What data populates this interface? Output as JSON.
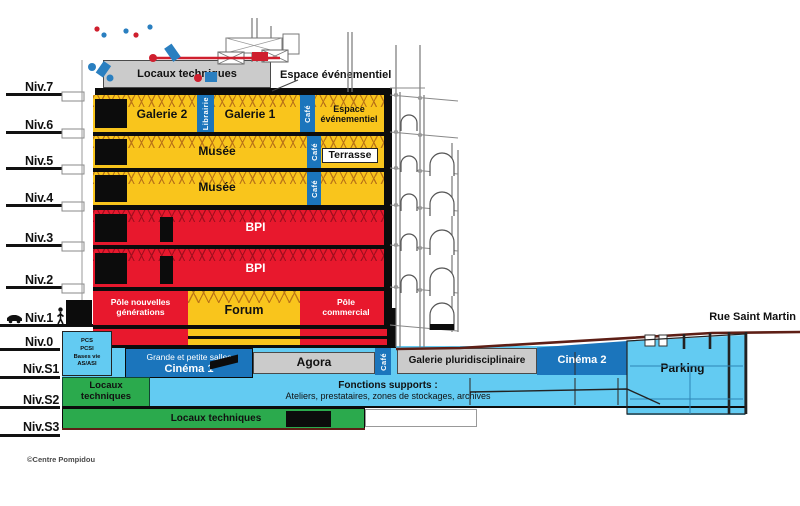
{
  "levels": [
    {
      "label": "Niv.7"
    },
    {
      "label": "Niv.6"
    },
    {
      "label": "Niv.5"
    },
    {
      "label": "Niv.4"
    },
    {
      "label": "Niv.3"
    },
    {
      "label": "Niv.2"
    },
    {
      "label": "Niv.1"
    },
    {
      "label": "Niv.0"
    },
    {
      "label": "Niv.S1"
    },
    {
      "label": "Niv.S2"
    },
    {
      "label": "Niv.S3"
    }
  ],
  "labels": {
    "locaux_techniques": "Locaux techniques",
    "espace_evenementiel": "Espace événementiel",
    "espace_evenementiel_2l": "Espace\névénementiel",
    "galerie2": "Galerie 2",
    "librairie": "Librairie",
    "galerie1": "Galerie 1",
    "cafe": "Café",
    "musee": "Musée",
    "terrasse": "Terrasse",
    "bpi": "BPI",
    "pole_nouvelles": "Pôle nouvelles\ngénérations",
    "forum": "Forum",
    "pole_commercial": "Pôle\ncommercial",
    "pcs_block": "PCS\nPCSI\nBases vie\nAS/ASI",
    "cinema1_sub": "Grande et petite salles",
    "cinema1": "Cinéma 1",
    "agora": "Agora",
    "galerie_pluridisciplinaire": "Galerie pluridisciplinaire",
    "cinema2": "Cinéma 2",
    "parking": "Parking",
    "locaux_2l": "Locaux\ntechniques",
    "fonctions_titre": "Fonctions supports :",
    "fonctions_desc": "Ateliers, prestataires, zones de stockages, archives",
    "rue_saint_martin": "Rue Saint Martin",
    "credit": "©Centre Pompidou"
  },
  "icons": {
    "car": "car-silhouette-at-street-level",
    "person": "person-silhouette-at-street-level"
  },
  "colors": {
    "yellow_public": "#F9C51C",
    "red_bpi": "#E8182D",
    "blue_services": "#1B75BC",
    "lightblue_basement": "#63CBF2",
    "green_technical": "#2BAA4D",
    "gray_neutral": "#CBCBCB",
    "street_line": "#5E1F16"
  }
}
